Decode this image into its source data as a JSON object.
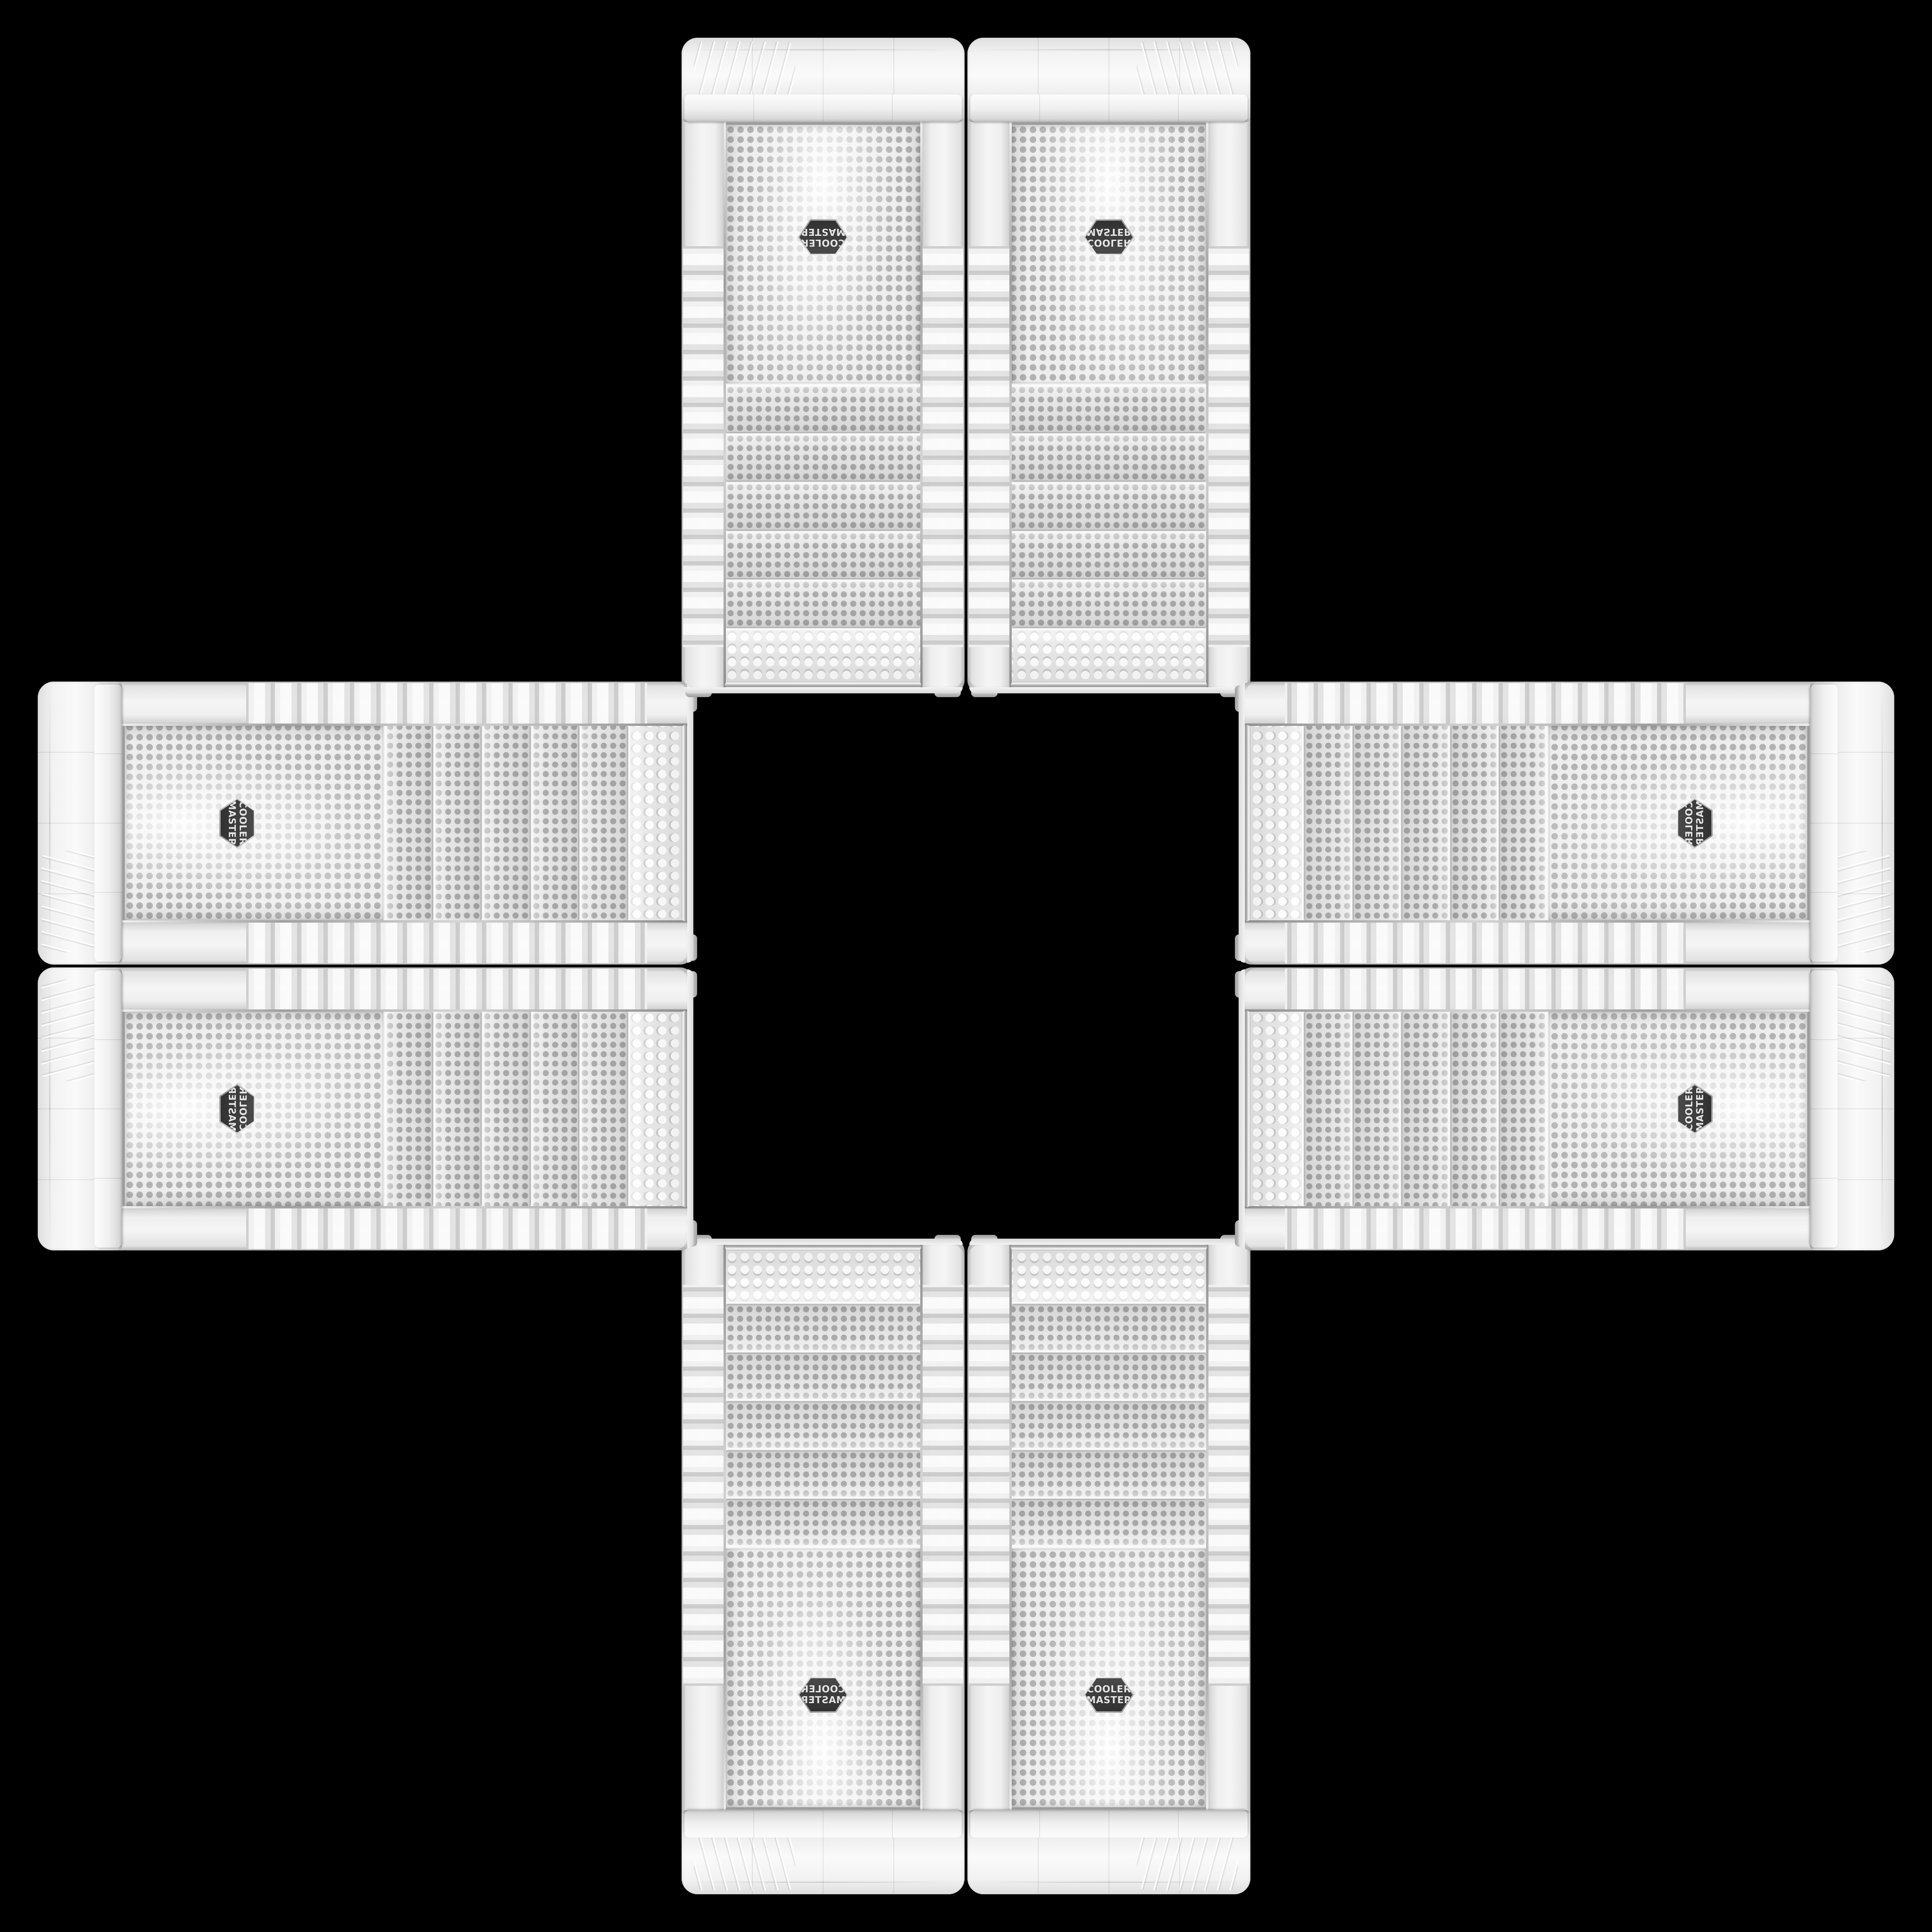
{
  "scene": {
    "background_color": "#000000",
    "description": "Eight identical white Cooler Master tower PC cases laid edge-to-edge to form a mirrored plus / cross pattern on a black background",
    "arrangement": [
      "top-left",
      "top-right",
      "left-top",
      "right-top",
      "left-bottom",
      "right-bottom",
      "bottom-left",
      "bottom-right"
    ]
  },
  "badge": {
    "line1": "COOLER",
    "line2": "MASTER",
    "face_color": "#3f3f3f",
    "rim_color": "#c9c9c9",
    "text_color": "#e6e6e6"
  },
  "case_colors": {
    "shell_white": "#f3f3f3",
    "shell_shadow": "#b2b2b2",
    "mesh_base": "#ededed",
    "mesh_dot": "#b2b2b2",
    "chrome_trim": "#9a9a9a"
  }
}
